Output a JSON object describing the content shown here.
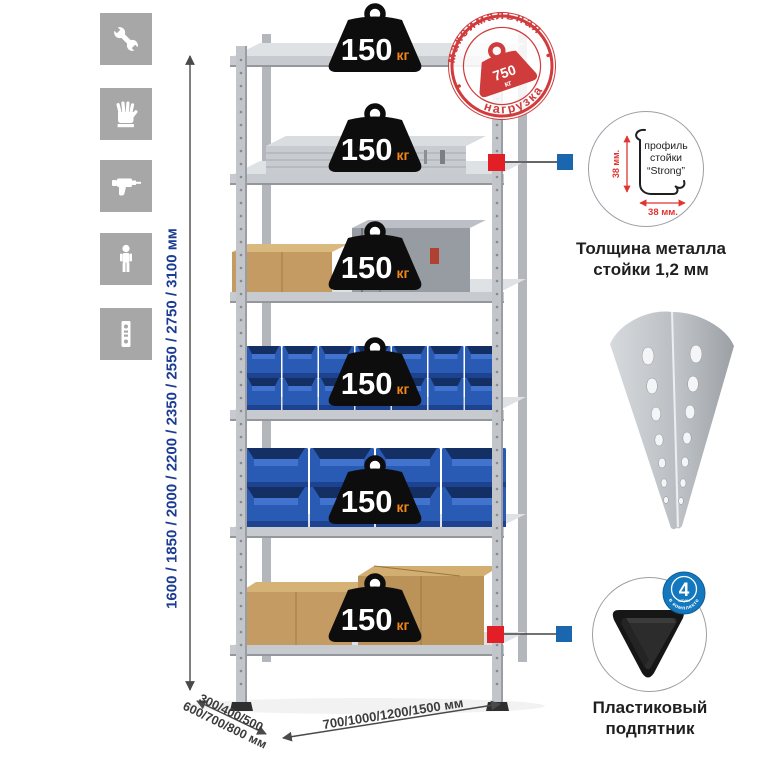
{
  "sidebar": {
    "icons": [
      {
        "name": "wrench-icon"
      },
      {
        "name": "gloves-icon"
      },
      {
        "name": "drill-icon"
      },
      {
        "name": "person-icon"
      },
      {
        "name": "perforated-strip-icon"
      }
    ]
  },
  "dimensions": {
    "height": "1600 / 1850 / 2000 / 2200 / 2350 / 2550 / 2750 / 3100 мм",
    "depth_line1": "300/400/500",
    "depth_line2": "600/700/800 мм",
    "width": "700/1000/1200/1500 мм"
  },
  "shelf_badge": {
    "value": "150",
    "unit": "кг"
  },
  "rack": {
    "shelves_count": 6
  },
  "max_load_stamp": {
    "arc_top": "максимальная",
    "arc_bottom": "нагрузка",
    "value": "750",
    "unit": "кг"
  },
  "profile_detail": {
    "label_line1": "профиль",
    "label_line2": "стойки",
    "label_line3": "“Strong”",
    "dim_vertical": "38 мм.",
    "dim_horizontal": "38 мм.",
    "caption_line1": "Толщина металла",
    "caption_line2": "стойки 1,2 мм"
  },
  "foot_detail": {
    "count": "4",
    "count_sub": "штуки",
    "arc_text": "в комплекте",
    "caption_line1": "Пластиковый",
    "caption_line2": "подпятник"
  },
  "colors": {
    "accent_red": "#d03b3c",
    "connector_red": "#e21e26",
    "connector_blue": "#1a67b0",
    "dim_blue": "#1b3c92",
    "badge_black": "#0d0d0d",
    "unit_orange": "#f0861c",
    "bin_blue": "#2a5bb4"
  }
}
